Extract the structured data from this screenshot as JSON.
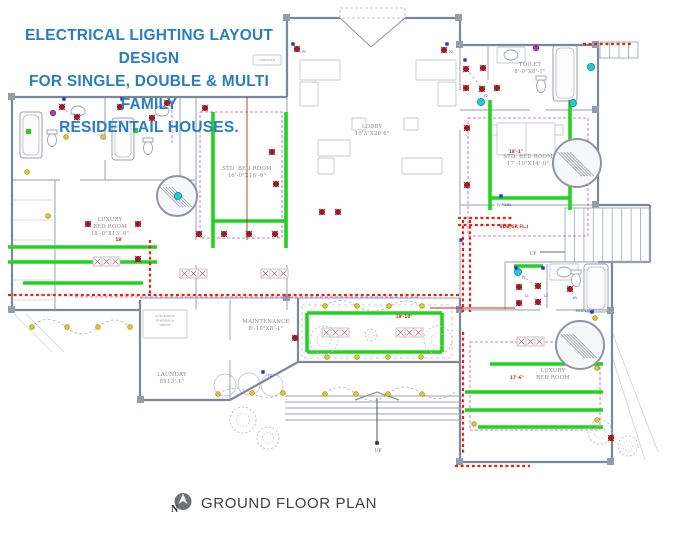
{
  "title": {
    "lines": [
      "ELECTRICAL LIGHTING LAYOUT DESIGN",
      "FOR SINGLE, DOUBLE & MULTI FAMILY",
      "RESIDENTAIL HOUSES."
    ],
    "color": "#2b7cc0"
  },
  "footer": {
    "label": "GROUND FLOOR PLAN",
    "compass_icon": "north-compass"
  },
  "colors": {
    "wall_ext": "#7e8796",
    "wall_int": "#aab1bc",
    "furniture": "#c5cad4",
    "circuit_green": "#21d320",
    "feeder_red": "#e02318",
    "wire_red": "#b03028",
    "wire_purple": "#b25cc0",
    "light_red": "#ae1520",
    "light_yellow": "#d9c92e",
    "fan_cyan": "#27c6d8",
    "switch_blue": "#2636c9"
  },
  "plan": {
    "exteriorWalls": [
      [
        12,
        97,
        287,
        97
      ],
      [
        12,
        97,
        12,
        310
      ],
      [
        12,
        310,
        140,
        310
      ],
      [
        287,
        97,
        287,
        18
      ],
      [
        287,
        18,
        340,
        18
      ],
      [
        405,
        18,
        460,
        18
      ],
      [
        460,
        18,
        460,
        45
      ],
      [
        460,
        45,
        598,
        45
      ],
      [
        598,
        45,
        598,
        205
      ],
      [
        598,
        205,
        650,
        205
      ],
      [
        650,
        205,
        650,
        262
      ],
      [
        598,
        262,
        650,
        262
      ],
      [
        612,
        262,
        612,
        462
      ],
      [
        612,
        462,
        460,
        462
      ],
      [
        460,
        462,
        460,
        298
      ],
      [
        298,
        298,
        298,
        362
      ],
      [
        298,
        362,
        460,
        362
      ],
      [
        140,
        300,
        140,
        400
      ],
      [
        140,
        400,
        230,
        400
      ],
      [
        230,
        400,
        298,
        362
      ]
    ],
    "interiorWalls": [
      [
        105,
        97,
        105,
        140
      ],
      [
        105,
        160,
        105,
        180
      ],
      [
        180,
        97,
        180,
        180
      ],
      [
        12,
        180,
        60,
        180
      ],
      [
        80,
        180,
        196,
        180
      ],
      [
        55,
        180,
        55,
        310
      ],
      [
        196,
        97,
        196,
        240
      ],
      [
        196,
        265,
        196,
        310
      ],
      [
        287,
        97,
        287,
        140
      ],
      [
        287,
        175,
        287,
        240
      ],
      [
        287,
        265,
        287,
        310
      ],
      [
        140,
        298,
        460,
        298
      ],
      [
        230,
        300,
        230,
        340
      ],
      [
        230,
        360,
        230,
        400
      ],
      [
        460,
        45,
        460,
        90
      ],
      [
        460,
        130,
        460,
        215
      ],
      [
        460,
        240,
        460,
        310
      ],
      [
        460,
        110,
        530,
        110
      ],
      [
        545,
        110,
        598,
        110
      ],
      [
        488,
        45,
        488,
        80
      ],
      [
        460,
        205,
        495,
        205
      ],
      [
        505,
        205,
        598,
        205
      ],
      [
        505,
        262,
        612,
        262
      ],
      [
        505,
        262,
        505,
        310
      ],
      [
        460,
        310,
        540,
        310
      ],
      [
        556,
        310,
        612,
        310
      ],
      [
        547,
        264,
        547,
        308
      ]
    ],
    "lightLines": [
      [
        14,
        200,
        53,
        200
      ],
      [
        14,
        220,
        53,
        220
      ],
      [
        14,
        240,
        53,
        240
      ],
      [
        14,
        260,
        53,
        260
      ],
      [
        14,
        280,
        53,
        280
      ],
      [
        14,
        300,
        53,
        300
      ],
      [
        14,
        314,
        52,
        352
      ],
      [
        26,
        314,
        64,
        352
      ],
      [
        612,
        332,
        658,
        452
      ],
      [
        612,
        356,
        645,
        460
      ]
    ],
    "pillars": [
      [
        8,
        93
      ],
      [
        283,
        14
      ],
      [
        455,
        14
      ],
      [
        592,
        41
      ],
      [
        8,
        306
      ],
      [
        607,
        307
      ],
      [
        456,
        306
      ],
      [
        607,
        458
      ],
      [
        456,
        458
      ],
      [
        137,
        396
      ],
      [
        283,
        294
      ],
      [
        456,
        41
      ],
      [
        592,
        106
      ],
      [
        592,
        201
      ]
    ],
    "furnitureRects": [
      [
        300,
        60,
        40,
        20
      ],
      [
        300,
        82,
        18,
        24
      ],
      [
        416,
        60,
        40,
        20
      ],
      [
        438,
        82,
        18,
        24
      ],
      [
        318,
        140,
        32,
        16
      ],
      [
        318,
        158,
        16,
        16
      ],
      [
        402,
        158,
        40,
        16
      ],
      [
        352,
        118,
        14,
        12
      ],
      [
        404,
        118,
        14,
        12
      ],
      [
        497,
        123,
        58,
        32
      ],
      [
        489,
        125,
        8,
        10
      ],
      [
        555,
        125,
        8,
        10
      ],
      [
        253,
        55,
        28,
        10
      ],
      [
        143,
        310,
        44,
        28
      ],
      [
        497,
        47,
        28,
        16
      ],
      [
        550,
        264,
        28,
        16
      ]
    ],
    "furnitureLines": [
      [
        526,
        123,
        526,
        155
      ]
    ],
    "furnitureCircles": [
      [
        225,
        385,
        11
      ],
      [
        249,
        384,
        11
      ],
      [
        272,
        385,
        11
      ]
    ],
    "tubs": [
      [
        20,
        112,
        22,
        46
      ],
      [
        112,
        118,
        22,
        42
      ],
      [
        553,
        45,
        24,
        56
      ],
      [
        584,
        264,
        24,
        48
      ]
    ],
    "toilets": [
      [
        52,
        140
      ],
      [
        148,
        148
      ],
      [
        541,
        86
      ],
      [
        576,
        280
      ]
    ],
    "sinks": [
      [
        511,
        55
      ],
      [
        564,
        272
      ],
      [
        78,
        111
      ],
      [
        162,
        111
      ]
    ],
    "grayDashedRects": [
      [
        302,
        305,
        150,
        53
      ]
    ],
    "dashedCurves": [
      "M30,327 Q48,312 66,327 Q82,341 98,327 Q114,313 130,327",
      "M325,394 Q340,380 356,394 Q372,407 388,394 Q405,380 422,394 Q440,404 455,392",
      "M325,306 Q341,295 357,306 Q373,316 389,306 Q406,296 422,306",
      "M62,107 Q85,128 103,137",
      "M466,69 Q476,80 483,89",
      "M518,272 Q530,282 538,288",
      "M218,394 Q235,383 252,393 Q267,402 283,393"
    ],
    "purpleDashedRects": [
      [
        200,
        112,
        82,
        126
      ],
      [
        468,
        118,
        120,
        118
      ],
      [
        470,
        342,
        130,
        88
      ]
    ],
    "purpleDashedLines": [
      [
        75,
        297,
        420,
        297
      ],
      [
        172,
        100,
        172,
        145
      ]
    ],
    "greenLines": [
      [
        8,
        247,
        157,
        247
      ],
      [
        8,
        262,
        157,
        262
      ],
      [
        23,
        283,
        143,
        283
      ],
      [
        213,
        112,
        213,
        248
      ],
      [
        286,
        112,
        286,
        248
      ],
      [
        213,
        221,
        286,
        221
      ],
      [
        490,
        100,
        490,
        210
      ],
      [
        570,
        100,
        570,
        210
      ],
      [
        490,
        198,
        570,
        198
      ],
      [
        514,
        266,
        543,
        266
      ],
      [
        307,
        313,
        442,
        313
      ],
      [
        307,
        352,
        442,
        352
      ],
      [
        307,
        313,
        307,
        352
      ],
      [
        442,
        313,
        442,
        352
      ],
      [
        490,
        364,
        603,
        364
      ],
      [
        465,
        392,
        603,
        392
      ],
      [
        465,
        410,
        603,
        410
      ],
      [
        478,
        427,
        603,
        427
      ]
    ],
    "greenSquares": [
      [
        26,
        129
      ],
      [
        133,
        128
      ]
    ],
    "redDashed": [
      [
        150,
        240,
        150,
        295
      ],
      [
        8,
        295,
        460,
        295
      ],
      [
        463,
        220,
        463,
        312
      ],
      [
        470,
        220,
        470,
        312
      ],
      [
        458,
        218,
        514,
        218
      ],
      [
        458,
        225,
        514,
        225
      ],
      [
        463,
        332,
        463,
        455
      ],
      [
        455,
        466,
        530,
        466
      ],
      [
        583,
        44,
        632,
        44
      ]
    ],
    "redLines": [
      [
        247,
        97,
        247,
        240
      ],
      [
        430,
        308,
        515,
        308
      ]
    ],
    "tableStrips": [
      [
        322,
        328,
        3
      ],
      [
        396,
        328,
        3
      ],
      [
        180,
        269,
        3
      ],
      [
        261,
        269,
        3
      ],
      [
        93,
        257,
        3
      ],
      [
        517,
        337,
        3
      ]
    ],
    "fans": [
      [
        177,
        196,
        20
      ],
      [
        577,
        163,
        24
      ],
      [
        580,
        345,
        24
      ]
    ],
    "plants": [
      [
        324,
        340,
        14
      ],
      [
        438,
        340,
        14
      ],
      [
        243,
        420,
        13
      ],
      [
        268,
        438,
        11
      ],
      [
        600,
        432,
        12
      ],
      [
        628,
        446,
        10
      ],
      [
        371,
        335,
        6
      ]
    ],
    "stairs": {
      "blocks": [
        {
          "x": 565,
          "y": 208,
          "w": 85,
          "h": 54,
          "n": 9
        },
        {
          "x": 600,
          "y": 42,
          "w": 38,
          "h": 16,
          "n": 4
        }
      ],
      "arrow": [
        540,
        252,
        565,
        252
      ]
    },
    "steps": {
      "x": 285,
      "w": 177,
      "ys": [
        396,
        402,
        408,
        414,
        420
      ],
      "chevron": "355,400 377,392 399,400",
      "pole": [
        377,
        398,
        377,
        443
      ],
      "dot": [
        377,
        443
      ]
    },
    "door": {
      "dashRect": [
        340,
        8,
        65,
        10
      ],
      "lines": [
        [
          340,
          18,
          371,
          47
        ],
        [
          405,
          18,
          371,
          47
        ]
      ]
    },
    "lights": {
      "red": [
        [
          62,
          107
        ],
        [
          77,
          117
        ],
        [
          120,
          107
        ],
        [
          152,
          118
        ],
        [
          167,
          103
        ],
        [
          205,
          108
        ],
        [
          272,
          152
        ],
        [
          276,
          184
        ],
        [
          199,
          234
        ],
        [
          224,
          234
        ],
        [
          249,
          234
        ],
        [
          275,
          234
        ],
        [
          297,
          49
        ],
        [
          444,
          50
        ],
        [
          466,
          69
        ],
        [
          483,
          68
        ],
        [
          466,
          88
        ],
        [
          482,
          89
        ],
        [
          497,
          88
        ],
        [
          467,
          128
        ],
        [
          467,
          185
        ],
        [
          519,
          287
        ],
        [
          538,
          286
        ],
        [
          519,
          303
        ],
        [
          538,
          302
        ],
        [
          570,
          289
        ],
        [
          138,
          224
        ],
        [
          138,
          259
        ],
        [
          88,
          224
        ],
        [
          322,
          212
        ],
        [
          338,
          212
        ],
        [
          295,
          338
        ],
        [
          611,
          438
        ]
      ],
      "yellow": [
        [
          66,
          137
        ],
        [
          103,
          137
        ],
        [
          27,
          172
        ],
        [
          48,
          216
        ],
        [
          32,
          327
        ],
        [
          67,
          327
        ],
        [
          98,
          327
        ],
        [
          130,
          327
        ],
        [
          325,
          306
        ],
        [
          357,
          306
        ],
        [
          389,
          306
        ],
        [
          422,
          306
        ],
        [
          327,
          357
        ],
        [
          357,
          357
        ],
        [
          388,
          357
        ],
        [
          421,
          357
        ],
        [
          325,
          394
        ],
        [
          356,
          394
        ],
        [
          388,
          394
        ],
        [
          422,
          394
        ],
        [
          218,
          394
        ],
        [
          252,
          393
        ],
        [
          283,
          393
        ],
        [
          597,
          368
        ],
        [
          597,
          420
        ],
        [
          474,
          424
        ],
        [
          595,
          318
        ]
      ],
      "cyan": [
        [
          178,
          196
        ],
        [
          481,
          102
        ],
        [
          573,
          103
        ],
        [
          591,
          67
        ],
        [
          518,
          272
        ]
      ],
      "purple": [
        [
          53,
          113
        ],
        [
          536,
          48
        ]
      ],
      "blueSquares": [
        [
          64,
          99
        ],
        [
          122,
          99
        ],
        [
          293,
          44
        ],
        [
          447,
          44
        ],
        [
          465,
          60
        ],
        [
          516,
          268
        ],
        [
          543,
          268
        ],
        [
          501,
          196
        ],
        [
          592,
          312
        ],
        [
          461,
          240
        ],
        [
          263,
          372
        ]
      ]
    },
    "labels": {
      "rooms": [
        {
          "lines": [
            "LUXURY",
            "BED ROOM",
            "18'-0\"X13'-0\""
          ],
          "x": 110,
          "y": 221
        },
        {
          "lines": [
            "STD. BED ROOM",
            "16'-0\"X16'-6\""
          ],
          "x": 247,
          "y": 170
        },
        {
          "lines": [
            "LOBBY",
            "19'3\"X20'4\""
          ],
          "x": 372,
          "y": 128
        },
        {
          "lines": [
            "TOILET",
            "8'-0\"X6'-1\""
          ],
          "x": 530,
          "y": 66
        },
        {
          "lines": [
            "STD. BED ROOM",
            "17'-10\"X14'-0\""
          ],
          "x": 528,
          "y": 158
        },
        {
          "lines": [
            "MAINTENANCE",
            "8'-10\"X8'-1\""
          ],
          "x": 266,
          "y": 323
        },
        {
          "lines": [
            "LAUNDRY",
            "8X13'-1\""
          ],
          "x": 172,
          "y": 376
        },
        {
          "lines": [
            "LUXURY",
            "BED ROOM"
          ],
          "x": 553,
          "y": 372
        }
      ],
      "small": [
        {
          "lines": [
            "STACKABLE",
            "WASHER &",
            "DRYER"
          ],
          "x": 165,
          "y": 317
        },
        {
          "lines": [
            "CABINET"
          ],
          "x": 45,
          "y": 296
        },
        {
          "lines": [
            "DRESSER"
          ],
          "x": 267,
          "y": 61
        }
      ],
      "red": [
        {
          "text": "18'",
          "x": 119,
          "y": 241
        },
        {
          "text": "18'-1\"",
          "x": 516,
          "y": 153
        },
        {
          "text": "17'-6\"",
          "x": 517,
          "y": 379
        },
        {
          "text": "18'-10\"",
          "x": 404,
          "y": 318
        },
        {
          "text": "SDB(GR FL.)",
          "x": 514,
          "y": 228
        }
      ],
      "blue": [
        {
          "text": "TV PANEL",
          "x": 504,
          "y": 206
        },
        {
          "text": "ROSE LIGHT",
          "x": 585,
          "y": 312
        },
        {
          "text": "P1",
          "x": 304,
          "y": 53
        },
        {
          "text": "P2",
          "x": 451,
          "y": 53
        },
        {
          "text": "F1",
          "x": 524,
          "y": 279
        },
        {
          "text": "L1",
          "x": 527,
          "y": 297
        },
        {
          "text": "L2",
          "x": 546,
          "y": 297
        },
        {
          "text": "WL",
          "x": 575,
          "y": 299
        },
        {
          "text": "F2",
          "x": 486,
          "y": 97
        },
        {
          "text": "F4",
          "x": 270,
          "y": 377
        }
      ],
      "gray": [
        {
          "text": "UP",
          "x": 533,
          "y": 255
        },
        {
          "text": "UP",
          "x": 378,
          "y": 452
        }
      ]
    }
  }
}
